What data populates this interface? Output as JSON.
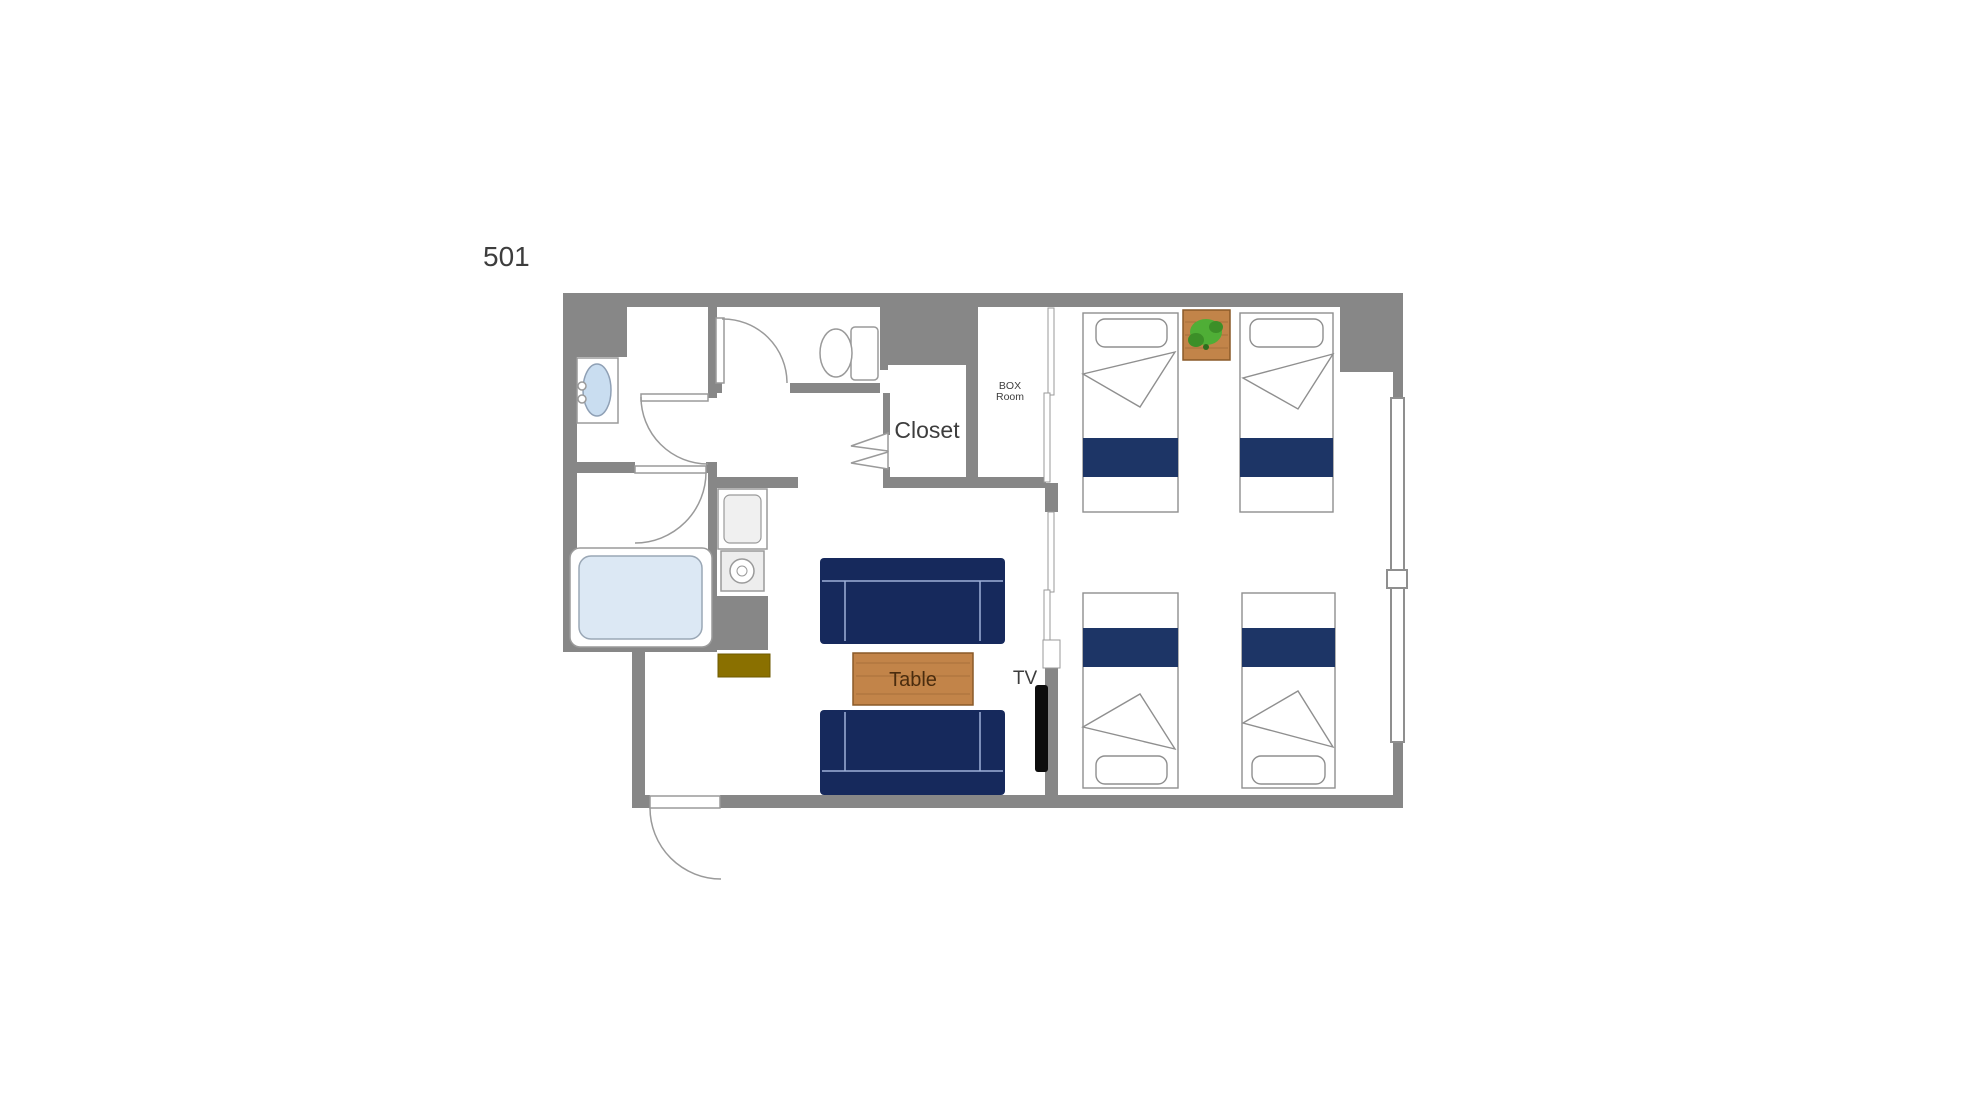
{
  "floor_plan": {
    "unit_label": "501",
    "labels": {
      "closet": "Closet",
      "box_room_line1": "BOX",
      "box_room_line2": "Room",
      "table": "Table",
      "tv": "TV"
    },
    "bed_count": 4,
    "sofa_count": 2,
    "fixtures": [
      "wash-basin",
      "toilet",
      "bathtub",
      "kitchen-sink",
      "stove",
      "entrance-door",
      "hinged-doors",
      "bifold-closet-door",
      "sliding-partition",
      "window",
      "plant",
      "low-table",
      "tv"
    ]
  },
  "colors": {
    "wall": "#878787",
    "outline": "#9a9a9a",
    "bed_navy": "#1d3566",
    "sofa_navy": "#16295c",
    "wood": "#c28449",
    "wood_dark": "#8a5a28",
    "wood_text": "#4a2c0e",
    "plant_green": "#4fae36",
    "plant_green_dark": "#3c8f28",
    "tub_blue": "#dce8f4",
    "basin_blue": "#c9ddf0",
    "mat_olive": "#8a7000",
    "tv_black": "#0d0d0d",
    "text": "#3d3d3d"
  }
}
